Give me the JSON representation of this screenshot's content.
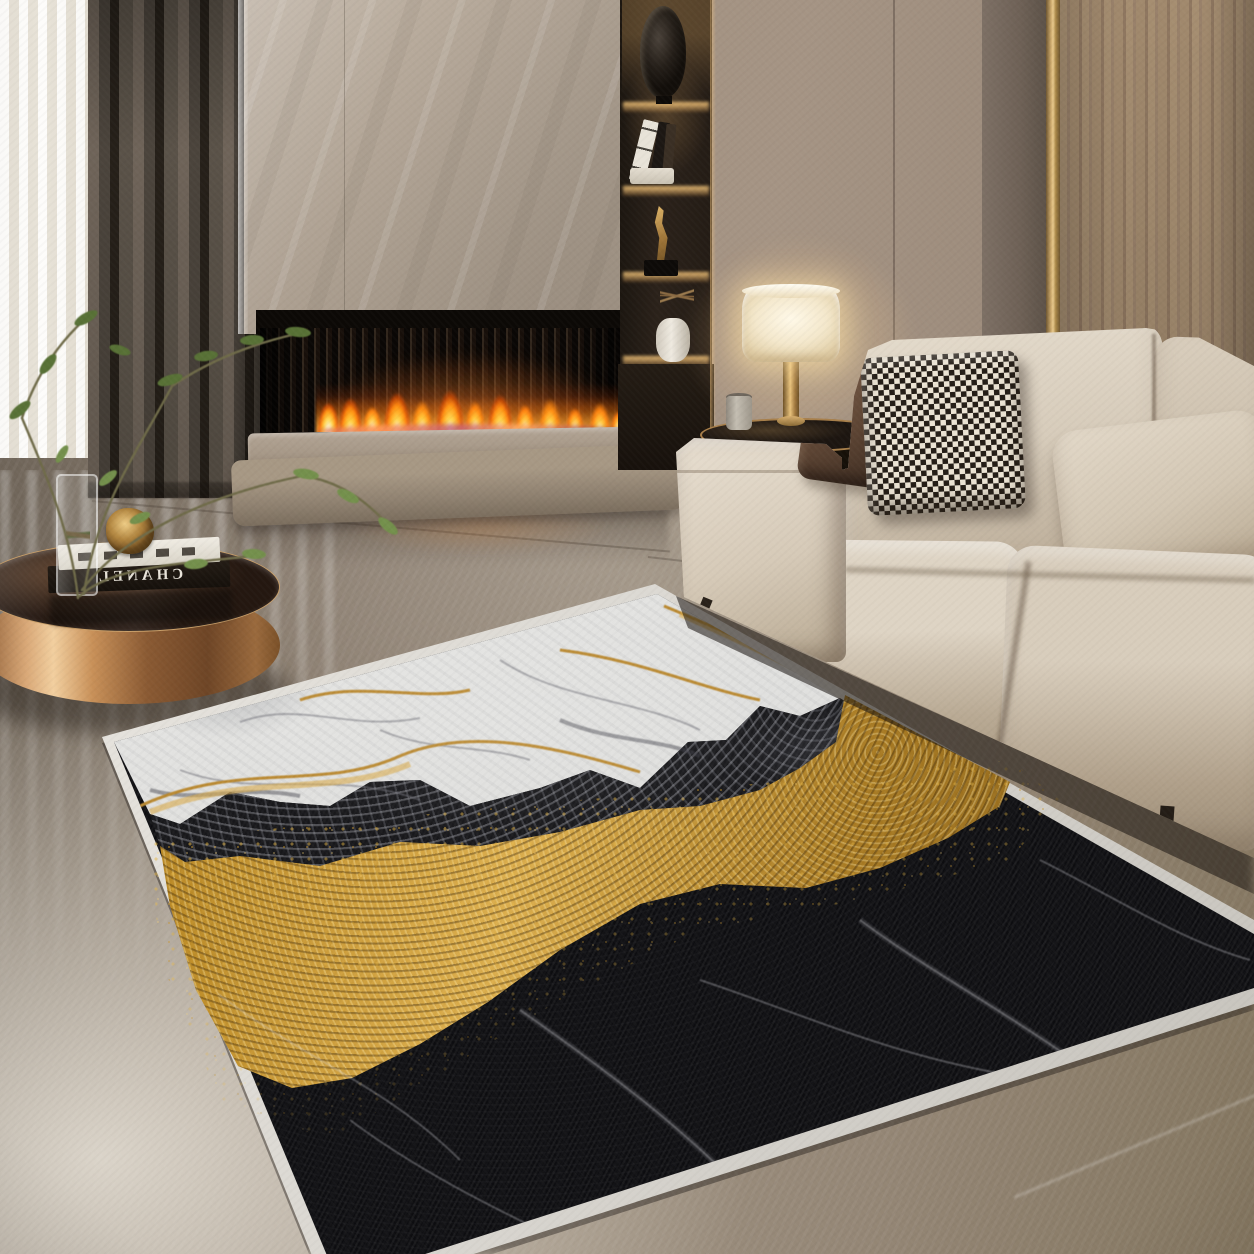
{
  "scene": {
    "type": "interior photograph",
    "description": "Modern luxury living room: lit linear fireplace in a beige marble surround, backlit display niche, beige fabric sectional sofa with pillows, brass table lamp, round rose-gold mirrored coffee table with books and a glass vase of green branches, and a black-white-gold marble-pattern area rug on a polished grey marble floor",
    "objects": {
      "sheer_curtain": {
        "label": "sheer white curtain at window"
      },
      "drapes": {
        "label": "dark taupe floor-length drapes"
      },
      "fireplace": {
        "label": "linear fireplace with black slatted firebox",
        "status": "lit"
      },
      "fireplace_surround": {
        "label": "beige marble chimney panel"
      },
      "hearth": {
        "label": "two-tier beige stone hearth"
      },
      "display_niche": {
        "label": "backlit display shelves",
        "items": [
          "smoked glass sculpture",
          "leaning books",
          "gold figurine on black base",
          "white vase with dried twigs"
        ]
      },
      "table_lamp": {
        "label": "table lamp with white drum shade and brass base",
        "status": "on"
      },
      "side_table": {
        "label": "round dark side table with brass rim",
        "items": [
          "small grey cup"
        ]
      },
      "sofa": {
        "label": "beige fabric sectional sofa",
        "pillows": [
          "dark brown suede pillow",
          "black and white houndstooth pillow",
          "beige lumbar pillow"
        ]
      },
      "coffee_table": {
        "label": "round rose-gold mirrored coffee table"
      },
      "plant": {
        "label": "green leafy branches in a tall glass vase"
      },
      "rug": {
        "label": "marble-pattern area rug",
        "description": "white marble field with grey and gold veining flowing over a charcoal mottled band and a gold dust river into black marble with fine white veins",
        "border": "white serged binding"
      },
      "floor": {
        "label": "polished grey-taupe marble floor with bright window reflection"
      },
      "walls": {
        "label": "taupe plaster panels, dark accent panel, brass trim strip and wood veneer panel"
      }
    }
  },
  "coffee_table": {
    "book_spine_text": "CHANEL",
    "book_spine_note": "white serif lettering shown mirrored on black book spine",
    "second_book": "white spine with illegible black lettering"
  },
  "palette": {
    "wall_taupe": "#a29180",
    "wood_panel": "#a68e71",
    "brass_trim": "#caa76b",
    "marble_surround": "#b3a698",
    "flame_orange": "#ff9726",
    "flame_core": "#fff6cf",
    "sofa_beige": "#d7ccbb",
    "pillow_brown": "#5f4635",
    "rug_white": "#e9e9e7",
    "rug_black": "#0d0d10",
    "rug_gold": "#dcae4c",
    "floor_grey": "#9d9080",
    "table_rose_gold": "#d9a877"
  }
}
